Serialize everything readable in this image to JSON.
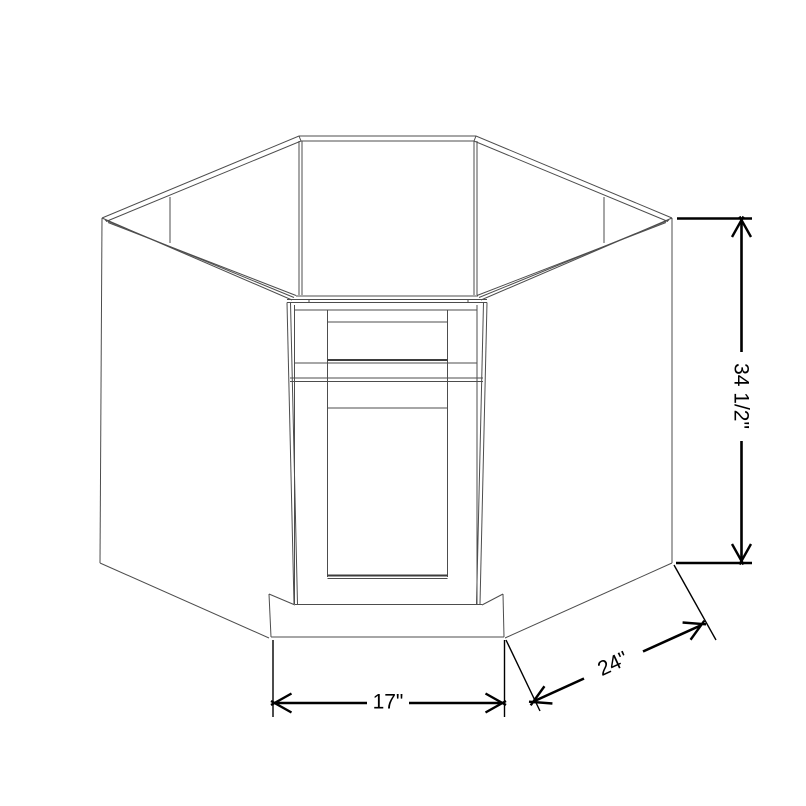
{
  "diagram": {
    "kind": "cabinet-line-drawing",
    "labels": {
      "height": "34 1/2\"",
      "width": "17\"",
      "depth": "24\""
    },
    "colors": {
      "background": "#ffffff",
      "cabinet_line": "#4d4d4d",
      "dimension_line": "#000000",
      "label_text": "#000000"
    }
  }
}
